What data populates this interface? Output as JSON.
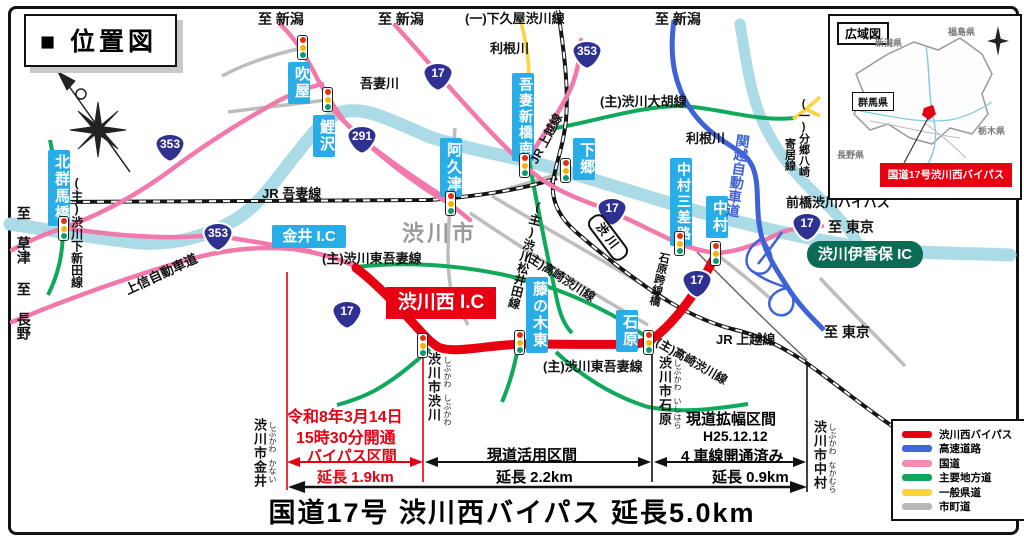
{
  "page": {
    "title_box": "■ 位置図",
    "bottom_title": "国道17号 渋川西バイパス 延長5.0km"
  },
  "colors": {
    "bypass_red": "#e60012",
    "expressway_blue": "#4066d8",
    "national_route_pink": "#f279ab",
    "major_local_green": "#0fa95c",
    "prefectural_yellow": "#ffd23f",
    "municipal_gray": "#bdbdbd",
    "sign_cyan": "#29ade6",
    "river_blue": "#aadbe6",
    "ic_pill_green": "#0b6b55",
    "shield_blue": "#2f3192"
  },
  "legend": {
    "items": [
      {
        "label": "渋川西バイパス",
        "color": "#e60012"
      },
      {
        "label": "高速道路",
        "color": "#4066d8"
      },
      {
        "label": "国道",
        "color": "#f08cb4"
      },
      {
        "label": "主要地方道",
        "color": "#0ea65a"
      },
      {
        "label": "一般県道",
        "color": "#ffd23f"
      },
      {
        "label": "市町道",
        "color": "#b8b8b8"
      }
    ]
  },
  "inset": {
    "title": "広域図",
    "niigata": "新潟県",
    "fukushima": "福島県",
    "gunma": "群馬県",
    "tochigi": "栃木県",
    "nagano": "長野県",
    "callout": "国道17号渋川西バイパス"
  },
  "shields": {
    "n17": "17",
    "n291": "291",
    "n353": "353"
  },
  "signs": {
    "fukiya": "吹屋",
    "koizawa": "鯉沢",
    "akutsu": "阿久津",
    "azuma_shinbashi_minami": "吾妻新橋南",
    "shimogo": "下郷",
    "kitagunma_bashi": "北群馬橋",
    "fujinoki_higashi": "藤の木東",
    "ishihara": "石原",
    "nakamura_sansaro": "中村三差路",
    "nakamura": "中村",
    "kanai_ic": "金井 I.C",
    "shibukawa_nishi_ic": "渋川西 I.C",
    "shibukawa_ikaho_ic": "渋川伊香保 IC",
    "station_shibukawa": "渋川"
  },
  "labels": {
    "to_niigata_1": "至 新潟",
    "to_niigata_2": "至 新潟",
    "to_niigata_3": "至 新潟",
    "to_tokyo_1": "至 東京",
    "to_tokyo_2": "至 東京",
    "to_kusatsu": "至 草津",
    "to_nagano": "至 長野",
    "shimokuya": "(一)下久屋渋川線",
    "tonegawa_1": "利根川",
    "tonegawa_2": "利根川",
    "agatsuma_river": "吾妻川",
    "ogo": "(主)渋川大胡線",
    "jr_agatsuma": "JR 吾妻線",
    "jr_joetsu_1": "JR 上越線",
    "jr_joetsu_2": "JR 上越線",
    "shibukawa_city": "渋川市",
    "higashi_agatsuma_1": "(主)渋川東吾妻線",
    "higashi_agatsuma_2": "(主)渋川東吾妻線",
    "takasaki_1": "(主)高崎渋川線",
    "takasaki_2": "(主)高崎渋川線",
    "matsuida": "(主)渋川松井田線",
    "shimoshinden": "(主)渋川下新田線",
    "bungo_yorii_1": "(一)分郷八崎",
    "bungo_yorii_2": "寄居線",
    "kanetsu": "関越自動車道",
    "kamishin": "上信自動車道",
    "maebashi_bypass": "前橋渋川バイパス",
    "ishihara_kosenkyo": "石原跨線橋"
  },
  "cities": {
    "shibukawa": "渋川市渋川",
    "kanai": "渋川市金井",
    "ishihara": "渋川市石原",
    "nakamura": "渋川市中村"
  },
  "furigana": {
    "shibukawa": "しぶかわ",
    "kanai": "かない",
    "ishihara": "いしはら",
    "nakamura": "なかむら"
  },
  "sections": {
    "open_date": "令和8年3月14日",
    "open_time": "15時30分開通",
    "bypass_label": "バイパス区間",
    "bypass_length": "延長 1.9km",
    "genko_label": "現道活用区間",
    "genko_length": "延長 2.2km",
    "kaku_label": "現道拡幅区間",
    "kaku_date": "H25.12.12",
    "kaku_lanes": "4 車線開通済み",
    "kaku_length": "延長 0.9km"
  }
}
